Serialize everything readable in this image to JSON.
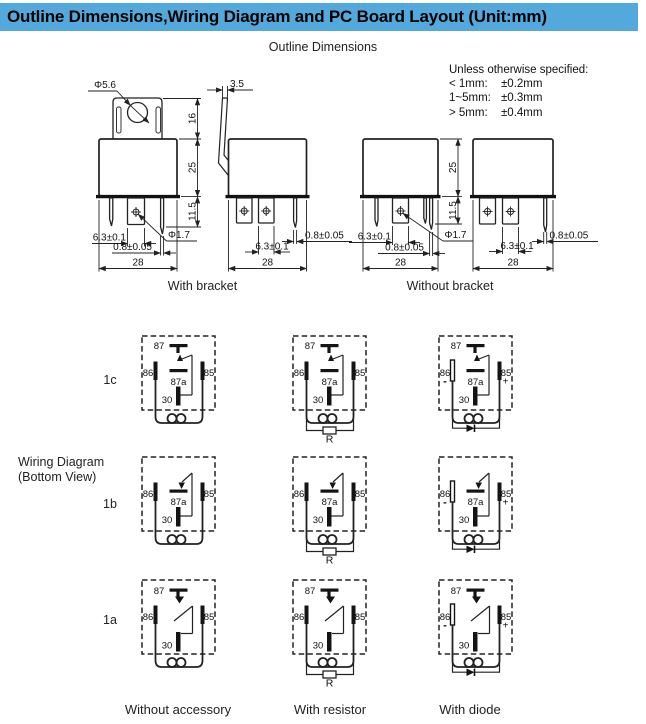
{
  "header": {
    "title": "Outline Dimensions,Wiring Diagram and PC Board Layout (Unit:mm)",
    "bg_color": "#54a9dc"
  },
  "outline": {
    "section_title": "Outline Dimensions",
    "tolerance_note": {
      "intro": "Unless otherwise specified:",
      "rows": [
        {
          "range": "< 1mm:",
          "value": "±0.2mm"
        },
        {
          "range": "1~5mm:",
          "value": "±0.3mm"
        },
        {
          "range": "> 5mm:",
          "value": "±0.4mm"
        }
      ]
    },
    "dims": {
      "bracket_hole": "Φ5.6",
      "bracket_height": "16",
      "body_height": "25",
      "pin_length": "11.5",
      "pin_width": "6.3±0.1",
      "pin_thickness": "0.8±0.05",
      "pin_hole": "Φ1.7",
      "body_width": "28",
      "bracket_thickness": "3.5"
    },
    "captions": {
      "with_bracket": "With bracket",
      "without_bracket": "Without bracket"
    }
  },
  "wiring": {
    "section_label_line1": "Wiring Diagram",
    "section_label_line2": "(Bottom View)",
    "rows": [
      {
        "label": "1c"
      },
      {
        "label": "1b"
      },
      {
        "label": "1a"
      }
    ],
    "terminals": {
      "t87": "87",
      "t87a": "87a",
      "t86": "86",
      "t85": "85",
      "t30": "30"
    },
    "accessory": {
      "resistor": "R",
      "plus": "+",
      "minus": "-"
    },
    "captions": [
      "Without accessory",
      "With resistor",
      "With diode"
    ]
  }
}
